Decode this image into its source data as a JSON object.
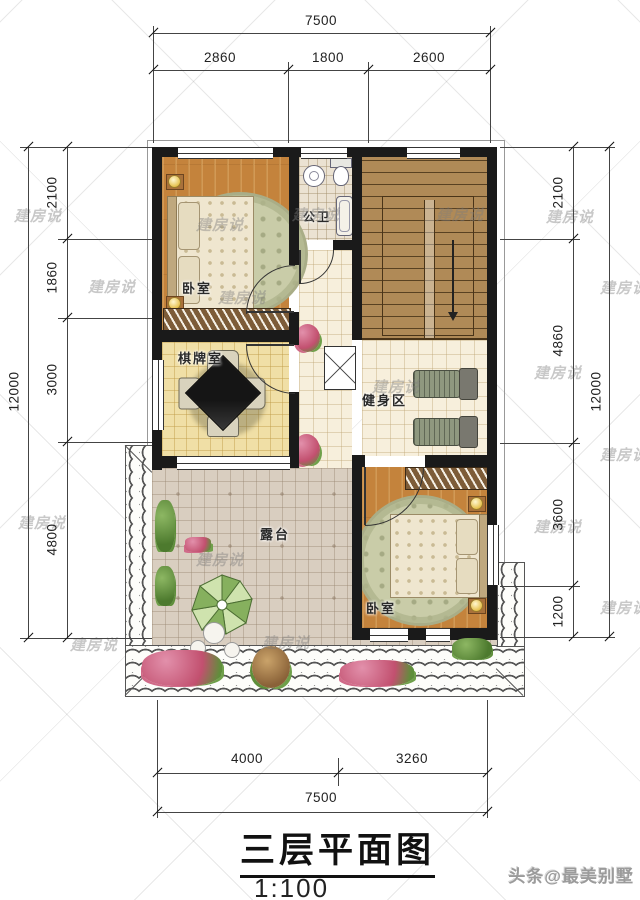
{
  "title": {
    "text": "三层平面图",
    "scale": "1:100"
  },
  "credit": "头条@最美别墅",
  "watermark": "建房说",
  "dims": {
    "top": {
      "total": "7500",
      "segs": [
        "2860",
        "1800",
        "2600"
      ]
    },
    "bottom": {
      "total": "7500",
      "segs": [
        "4000",
        "3260"
      ]
    },
    "left": {
      "total": "12000",
      "segs": [
        "2100",
        "1860",
        "3000",
        "4800"
      ]
    },
    "right": {
      "total": "12000",
      "segs": [
        "2100",
        "4860",
        "3600",
        "1200"
      ]
    }
  },
  "rooms": {
    "bedroom1": "卧室",
    "bathroom": "公卫",
    "chess": "棋牌室",
    "gym": "健身区",
    "terrace": "露台",
    "bedroom2": "卧室"
  },
  "colors": {
    "wall": "#1a1a1a",
    "bedroom_wood": "#c4833c",
    "stair_wood": "#b08a57",
    "chess_tile": "#f0dfa6",
    "hall_tile": "#f7efdc",
    "bath_tile": "#ebe2d2",
    "terrace_tile": "#d9cec0",
    "umbrella_green": "#86b05e",
    "dim_text": "#222222"
  }
}
